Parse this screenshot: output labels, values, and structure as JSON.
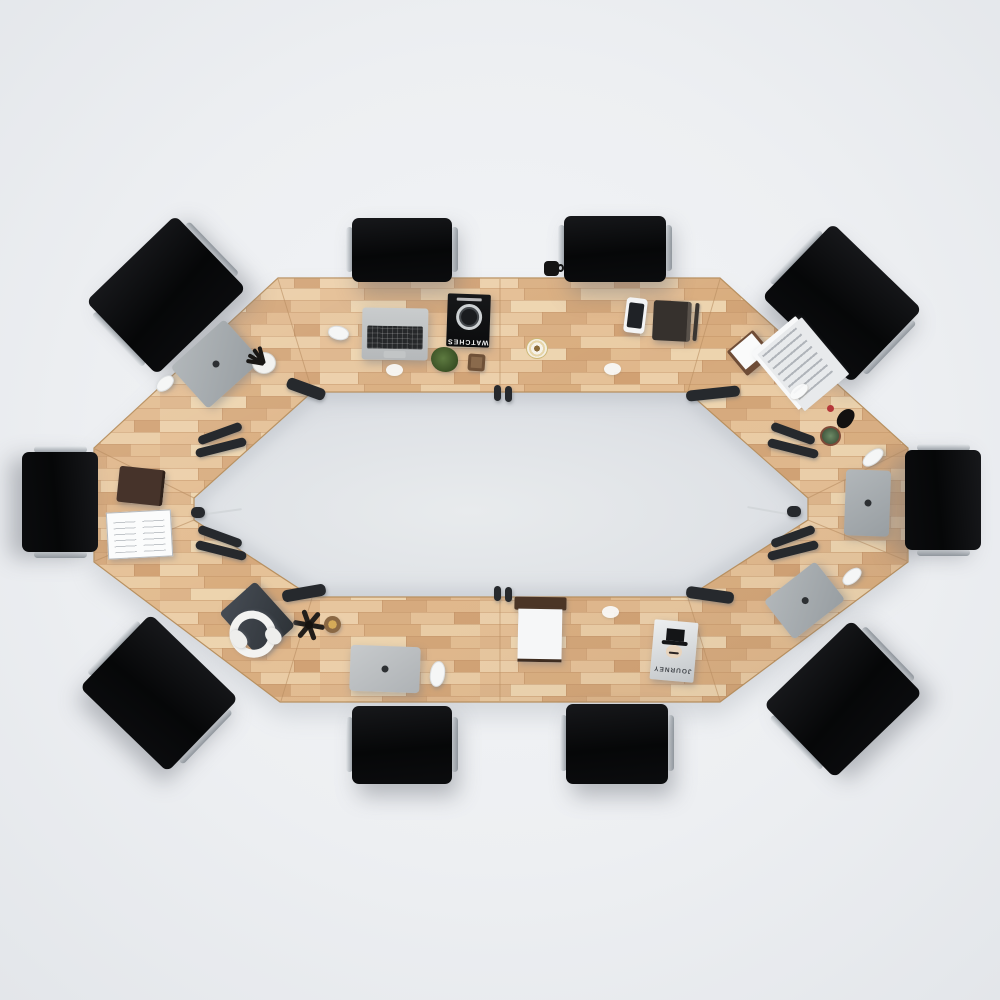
{
  "scene": {
    "description": "Top-down 3D render of an elongated octagonal ring conference table in light oak with ten black office chairs and desk accessories",
    "background_color": "#edeff2",
    "inner_floor_color": "#dfe2e6",
    "table": {
      "shape": "elongated octagonal ring",
      "material": "light oak plank top",
      "wood_colors": [
        "#e4bd92",
        "#d9ad7e",
        "#eacca4",
        "#edd4ae",
        "#d2a476",
        "#e7c69d"
      ],
      "edge_color": "#b8905f"
    },
    "chairs": {
      "count": 10,
      "upholstery_color": "#0b0c0e",
      "frame_color": "#c9ced3"
    },
    "magazines": {
      "watches": {
        "title": "WATCHES",
        "cover_color": "#0e0f11",
        "title_color": "#f1f1f1"
      },
      "journey": {
        "title": "JOURNEY",
        "cover_color": "#dfe2e4",
        "title_color": "#43474c"
      }
    },
    "items": [
      "open silver laptop with black keyboard",
      "closed gray laptop (top-left)",
      "closed gray laptop (right)",
      "closed gray laptop (bottom-right)",
      "closed silver macbook (bottom)",
      "white computer mice (5)",
      "WATCHES magazine with wristwatch cover",
      "JOURNEY magazine with portrait cover",
      "white smartphone",
      "dark notebook with pen",
      "document stack",
      "small notepad on brown pad",
      "open sketchbook",
      "dark leather folder",
      "white over-ear headphones on gray mat",
      "black spoke spinner ornament",
      "small woven basket",
      "white pen cup with black pens",
      "green plant",
      "succulent with black figurine",
      "gold-rimmed coffee cup",
      "woven brown coaster",
      "paper tray with wooden rail",
      "black mug on floor",
      "clamp-on black desk lamps along inner edge (12)"
    ]
  }
}
